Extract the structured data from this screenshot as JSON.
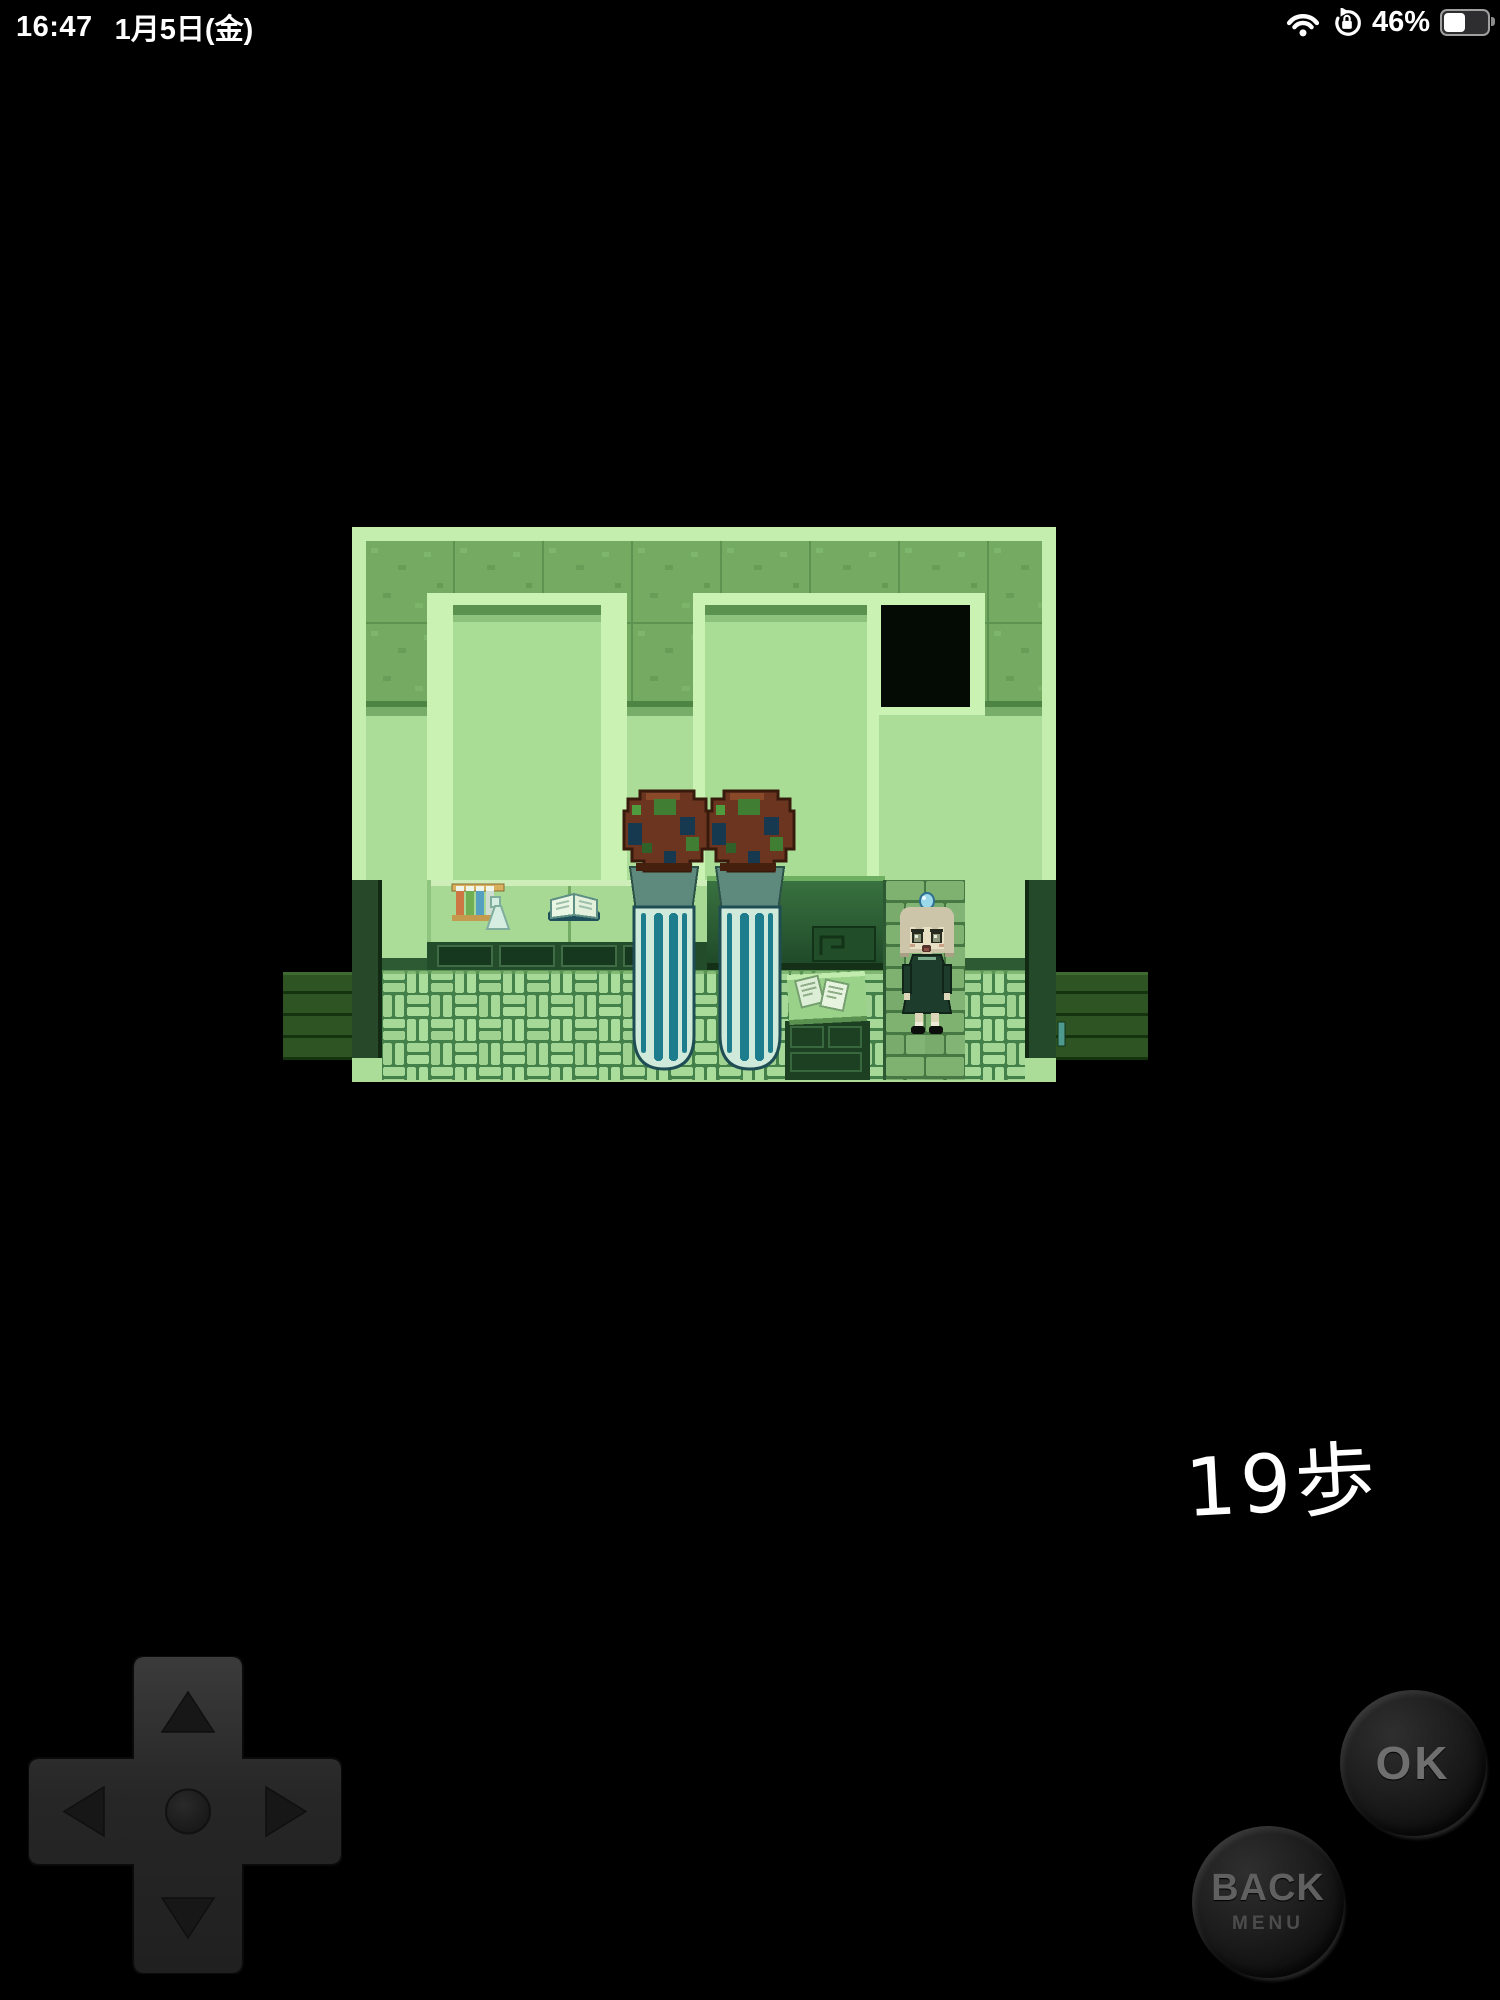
{
  "status_bar": {
    "time": "16:47",
    "date": "1月5日(金)",
    "battery_percent": "46%",
    "battery_level": 0.46,
    "icons": [
      "wifi-icon",
      "orientation-lock-icon",
      "battery-icon"
    ]
  },
  "game": {
    "step_counter": "19歩",
    "scene_objects": [
      "mossy-wall-band",
      "alcove-left",
      "alcove-right",
      "dark-doorway",
      "potion-rack",
      "open-book",
      "counter",
      "dark-bench",
      "specimen-tube-left",
      "specimen-tube-right",
      "papers-desk",
      "under-desk-cabinet",
      "girl-character",
      "brick-column",
      "basketweave-floor",
      "side-exit-left",
      "side-exit-right",
      "plank-corridor-left",
      "plank-corridor-right"
    ],
    "palette": {
      "wall_light": "#abdd99",
      "wall_frame": "#c3eeae",
      "moss_tile": "#74aa62",
      "floor_brick": "#a5d796",
      "floor_mortar": "#44814a",
      "bench_dark": "#2a5a32",
      "corridor_plank": "#2e5424",
      "tube_glass": "#cfeada",
      "tube_stripe": "#1e7d8c",
      "cap_brown": "#6b3520",
      "cap_navy": "#16394f",
      "cap_green": "#3f7e33",
      "dress_green": "#1d3c2c",
      "hair": "#cdc5a9",
      "skin": "#e7e0c4"
    }
  },
  "controls": {
    "dpad_directions": [
      "up",
      "left",
      "right",
      "down"
    ],
    "ok_label": "OK",
    "back_label": "BACK",
    "menu_label": "MENU"
  }
}
